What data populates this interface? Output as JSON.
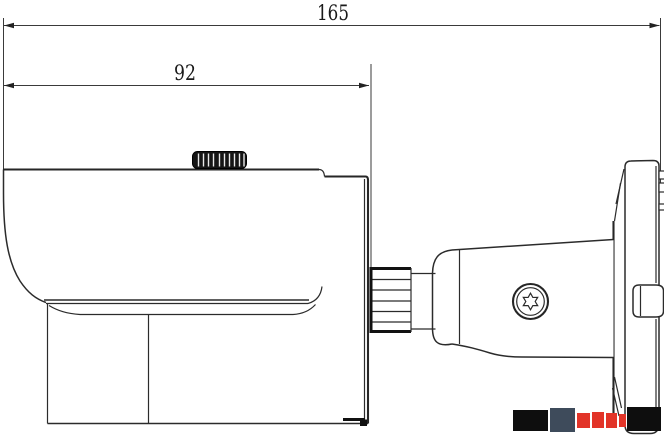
{
  "dimensions": {
    "overall_length": "165",
    "body_length": "92"
  },
  "colors": {
    "line": "#2b2b2b",
    "background": "#ffffff",
    "watermark_black": "#0e0e0e",
    "watermark_slate": "#3e4b5b",
    "watermark_red": "#e23428"
  }
}
